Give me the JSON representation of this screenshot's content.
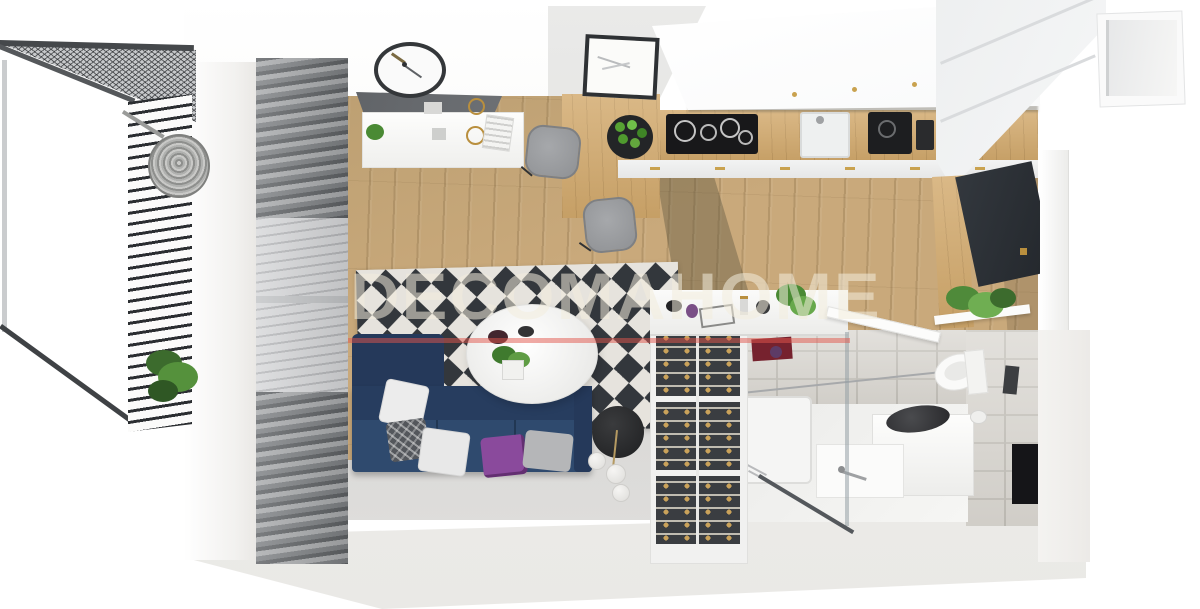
{
  "title": "3D studio apartment floor plan render",
  "watermark": {
    "text": "DECOMAHOME",
    "underline_color": "#e2564c"
  },
  "colors": {
    "background": "#ffffff",
    "floor_wood": "#c9a97b",
    "sofa_navy": "#2f4a6e",
    "pillow_purple": "#8a4a9c",
    "rug_dark": "#33373c",
    "rug_light": "#e6e3dd",
    "curtain_gray": "#7d8083",
    "counter_wood": "#d2a96c",
    "cooktop_black": "#18181a",
    "handle_gold": "#c9a24f",
    "tile_gray": "#d9d6d0",
    "wardrobe_panel_dark": "#2d3136",
    "plant_green": "#57a233",
    "lamp_black": "#2b2d2f"
  },
  "scene": {
    "balcony": [
      "mesh-canopy",
      "slatted-privacy-screen",
      "hanging-egg-chair",
      "potted-plant"
    ],
    "living_area": [
      "curtain-wall",
      "glass-sliding-door",
      "diamond-rug",
      "corner-sofa-navy",
      "throw-pillows",
      "round-coffee-table",
      "floor-lamp-globes",
      "console-with-mirror",
      "wall-clock"
    ],
    "kitchen": [
      "upper-cabinets-white",
      "wood-countertop",
      "induction-cooktop",
      "sink",
      "coffee-machine",
      "fruit-bowl",
      "dining-table",
      "two-gray-chairs",
      "wall-art-frame"
    ],
    "bathroom": [
      "shower-tray",
      "glass-partition",
      "glass-door-open",
      "washing-machine",
      "vanity-basin",
      "toilet",
      "toilet-paper-roll",
      "flush-plate",
      "wall-niche"
    ],
    "entry_wardrobe": [
      "wine-rack",
      "dresser-console",
      "dark-wardrobe-door",
      "wood-side-panel",
      "shelf-plant",
      "storage-box-open"
    ]
  }
}
